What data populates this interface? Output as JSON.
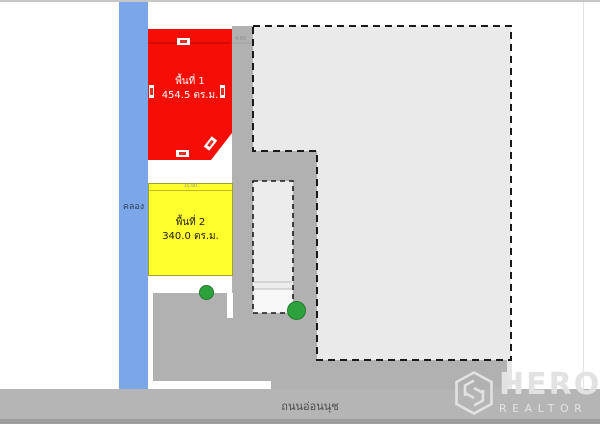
{
  "canal": {
    "label": "คลอง"
  },
  "road": {
    "label": "ถนนอ่อนนุช"
  },
  "areas": {
    "area1": {
      "title": "พื้นที่ 1",
      "size": "454.5 ตร.ม.",
      "color": "#f60d05"
    },
    "area2": {
      "title": "พื้นที่ 2",
      "size": "340.0 ตร.ม.",
      "color": "#ffff2e"
    }
  },
  "dimensions": {
    "top_right": "4.00",
    "area2_top": "15.00"
  },
  "colors": {
    "canal": "#7ba7e8",
    "road": "#b5b5b5",
    "paved": "#b1b1b1",
    "plot_fill": "#eaeaea",
    "inner_plot_fill": "#ececec",
    "tree": "#2da23c",
    "watermark": "#e2e2e2"
  },
  "watermark": {
    "brand": "HERO",
    "subtitle": "REALTOR"
  }
}
